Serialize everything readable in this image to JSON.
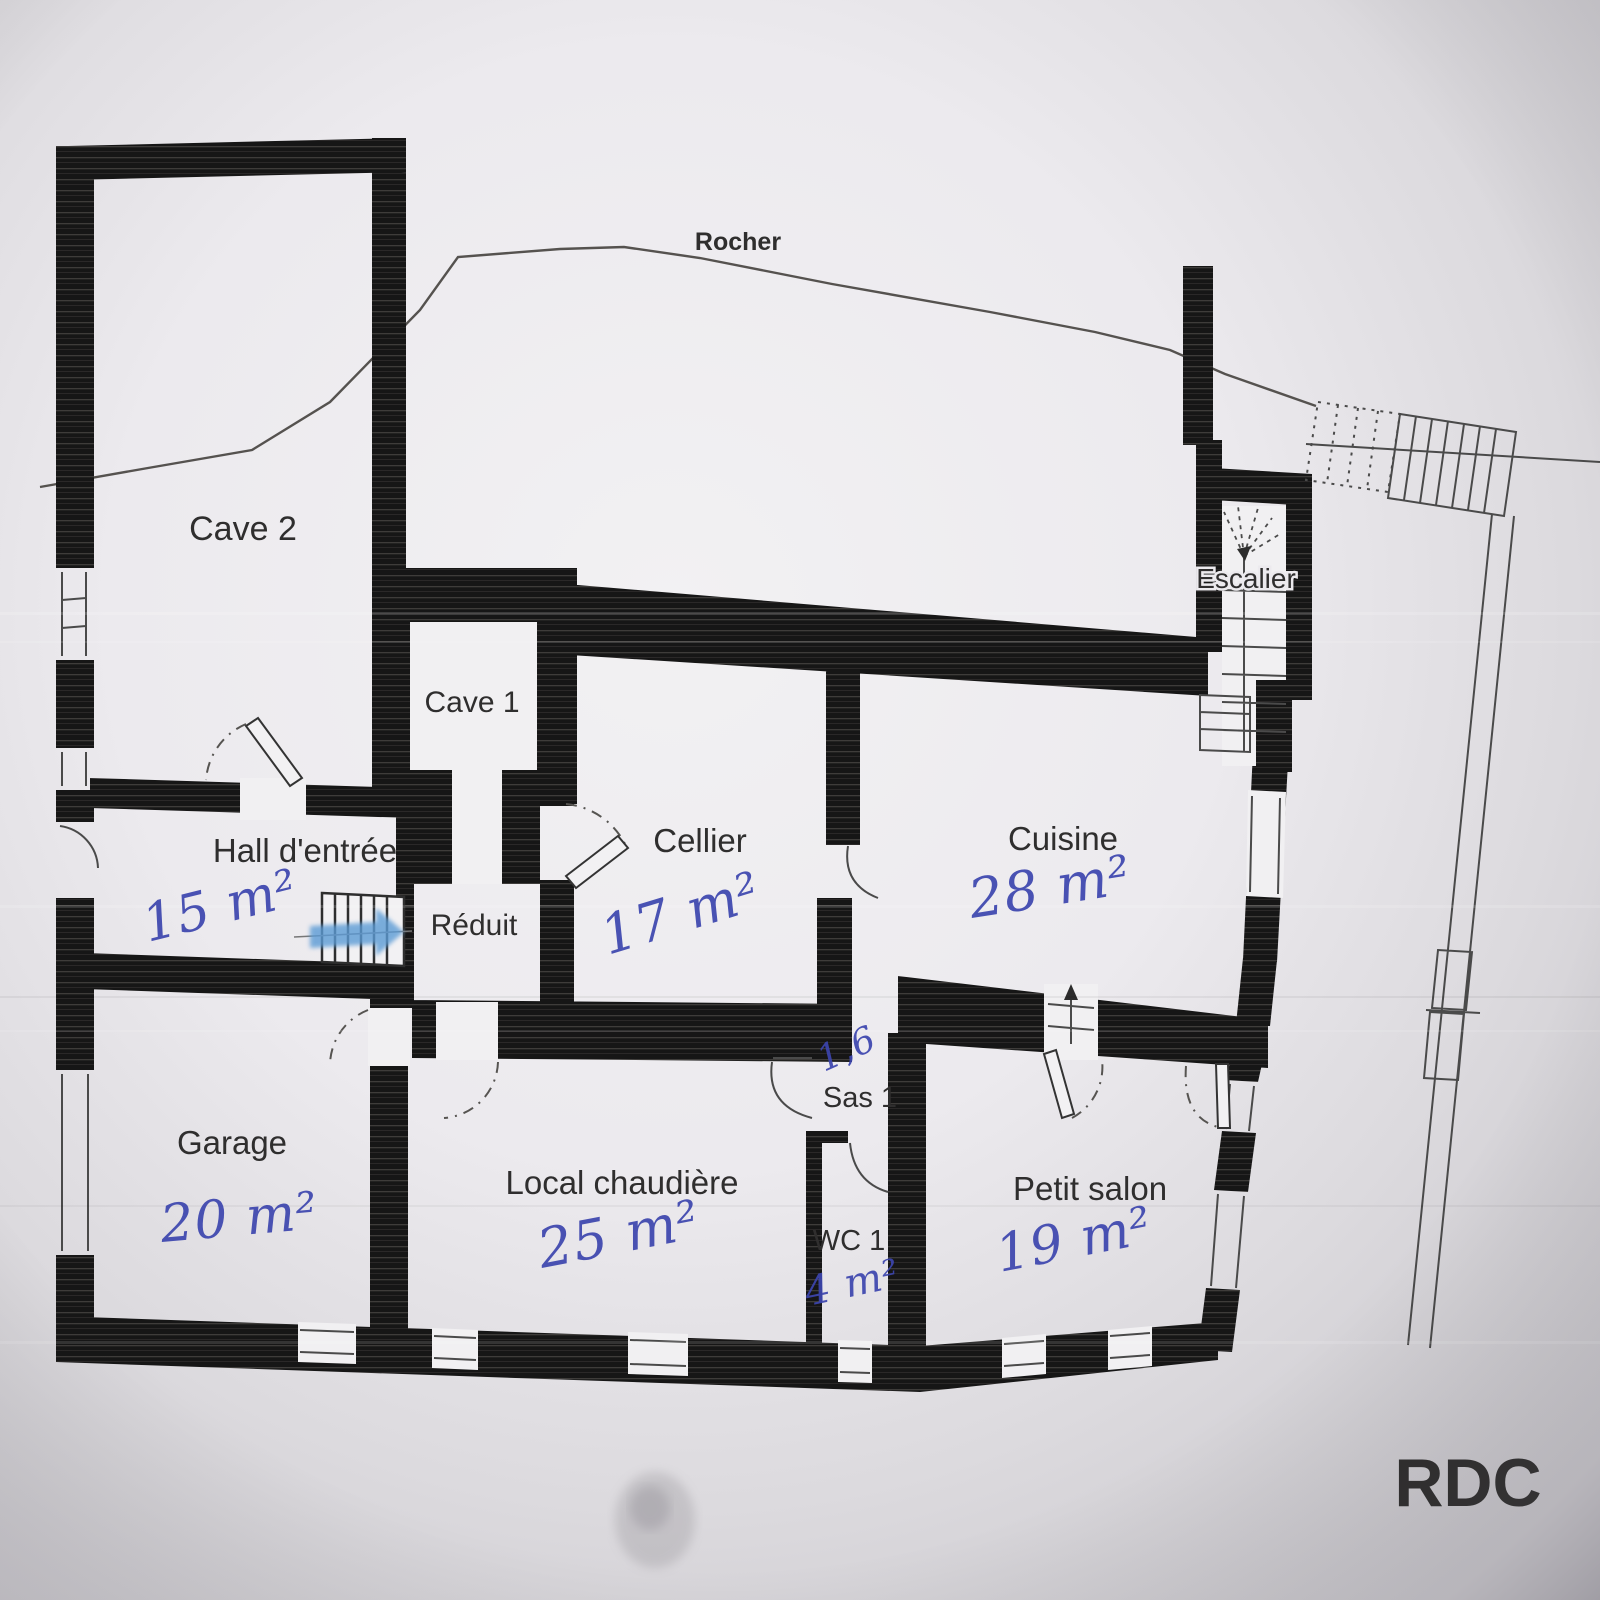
{
  "document": {
    "floor_label": "RDC"
  },
  "terrain": {
    "label": "Rocher"
  },
  "stairwell": {
    "label": "Escalier"
  },
  "rooms": {
    "cave2": {
      "label": "Cave 2"
    },
    "cave1": {
      "label": "Cave 1"
    },
    "hall": {
      "label": "Hall d'entrée",
      "area": "15 m²"
    },
    "reduit": {
      "label": "Réduit"
    },
    "cellier": {
      "label": "Cellier",
      "area": "17 m²"
    },
    "cuisine": {
      "label": "Cuisine",
      "area": "28 m²"
    },
    "garage": {
      "label": "Garage",
      "area": "20 m²"
    },
    "local_chaudiere": {
      "label": "Local chaudière",
      "area": "25 m²"
    },
    "sas1": {
      "label": "Sas 1",
      "area": "1,6"
    },
    "wc1": {
      "label": "WC 1",
      "area": "4 m²"
    },
    "petit_salon": {
      "label": "Petit salon",
      "area": "19 m²"
    }
  },
  "colors": {
    "paper": "#dddbdf",
    "wall_ink": "#161616",
    "line_ink": "#4a4a4a",
    "handwriting": "#3c45ae",
    "highlight_marker": "#5b9bd5"
  }
}
